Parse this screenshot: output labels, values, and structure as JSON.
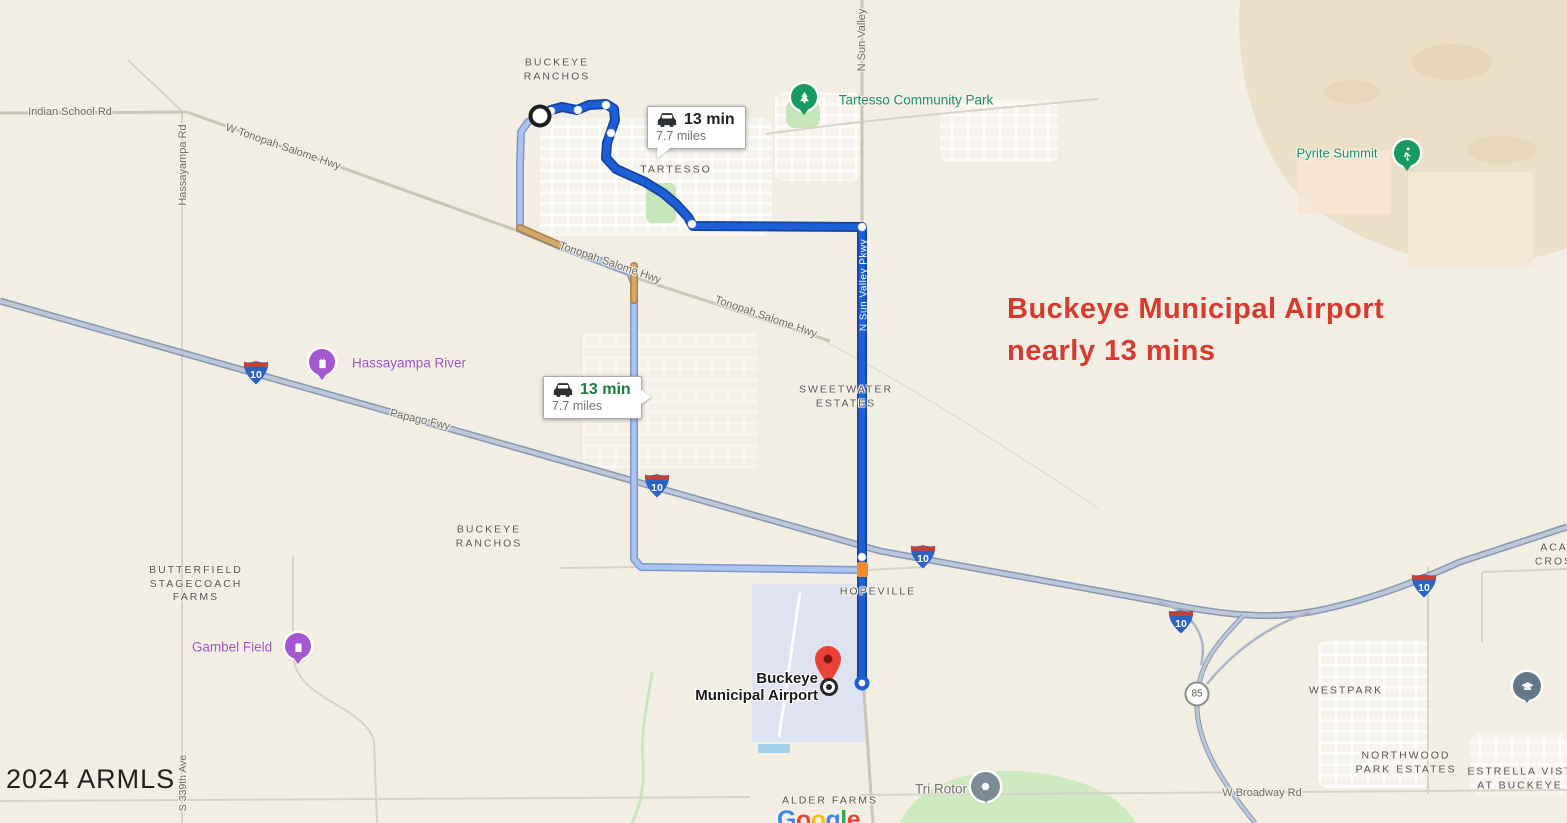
{
  "watermark": "2024 ARMLS",
  "attribution": [
    {
      "ch": "G",
      "color": "#4285F4"
    },
    {
      "ch": "o",
      "color": "#EA4335"
    },
    {
      "ch": "o",
      "color": "#FBBC05"
    },
    {
      "ch": "g",
      "color": "#4285F4"
    },
    {
      "ch": "l",
      "color": "#34A853"
    },
    {
      "ch": "e",
      "color": "#EA4335"
    }
  ],
  "annotation": {
    "line1": "Buckeye Municipal Airport",
    "line2": "nearly 13 mins",
    "color": "#d93a2e"
  },
  "route_info_primary": {
    "duration": "13 min",
    "distance": "7.7 miles"
  },
  "route_info_alternate": {
    "duration": "13 min",
    "distance": "7.7 miles"
  },
  "shields": {
    "interstate": "10",
    "state_route": "85"
  },
  "road_labels": {
    "indian_school": "Indian School Rd",
    "hassayampa_rd": "Hassayampa Rd",
    "w_tonopah_salome": "W Tonopah-Salome Hwy",
    "tonopah_salome_1": "Tonopah Salome Hwy",
    "tonopah_salome_2": "Tonopah Salome Hwy",
    "sun_valley_north": "N Sun Valley",
    "sun_valley_pkwy": "N Sun Valley Pkwy",
    "papago_fwy": "Papago Fwy",
    "s_339th_ave": "S 339th Ave",
    "broadway_rd": "W Broadway Rd"
  },
  "area_labels": {
    "buckeye_ranchos_north": [
      "BUCKEYE",
      "RANCHOS"
    ],
    "tartesso": [
      "TARTESSO"
    ],
    "sweetwater_estates": [
      "SWEETWATER",
      "ESTATES"
    ],
    "buckeye_ranchos_south": [
      "BUCKEYE",
      "RANCHOS"
    ],
    "butterfield": [
      "BUTTERFIELD",
      "STAGECOACH",
      "FARMS"
    ],
    "hopeville": [
      "HOPEVILLE"
    ],
    "westpark": [
      "WESTPARK"
    ],
    "northwood": [
      "NORTHWOOD",
      "PARK ESTATES"
    ],
    "estrella": [
      "ESTRELLA VIST",
      "AT BUCKEYE"
    ],
    "acacia_crossing": [
      "ACA",
      "CROS"
    ],
    "alder_farms": [
      "ALDER FARMS"
    ]
  },
  "poi_labels": {
    "tartesso_park": "Tartesso Community Park",
    "pyrite_summit": "Pyrite Summit",
    "hassayampa_river": "Hassayampa River",
    "gambel_field": "Gambel Field",
    "tri_rotor": "Tri Rotor"
  },
  "destination": {
    "line1": "Buckeye",
    "line2": "Municipal Airport"
  },
  "colors": {
    "primary_route": "#1c5fd6",
    "alternate_route": "#abc3ef",
    "traffic_orange": "#ee8b2e",
    "annotation_red": "#d93a2e",
    "park_green": "#1e9070",
    "poi_purple": "#9d53c9"
  }
}
